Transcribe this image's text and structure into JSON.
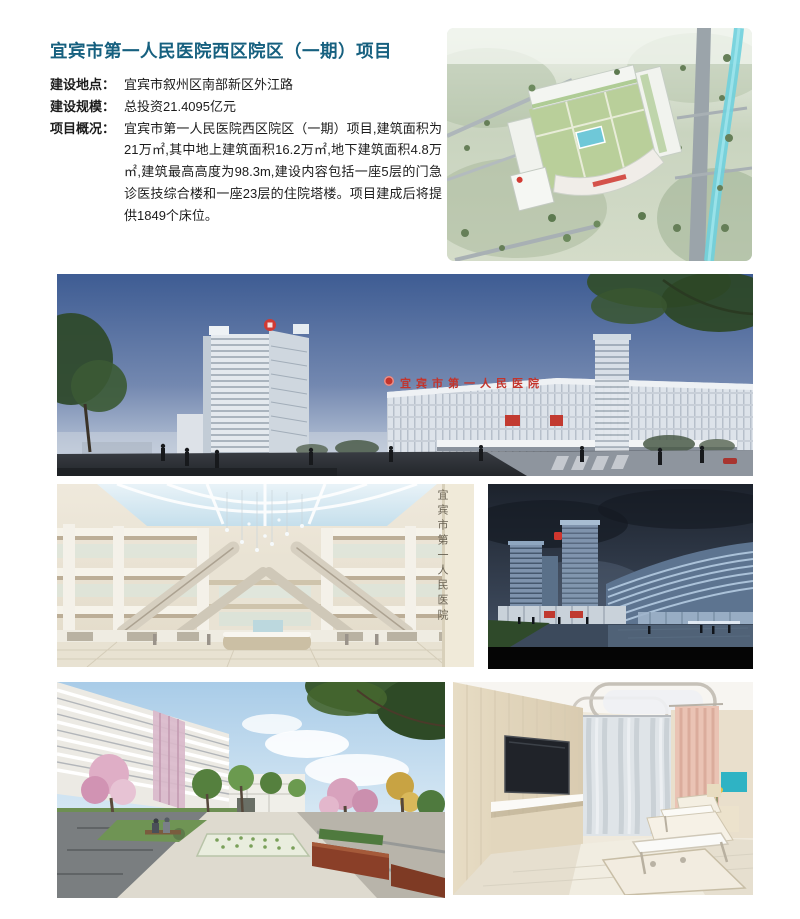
{
  "document": {
    "title": "宜宾市第一人民医院西区院区（一期）项目"
  },
  "info": {
    "rows": [
      {
        "label": "建设地点：",
        "value": "宜宾市叙州区南部新区外江路"
      },
      {
        "label": "建设规模：",
        "value": "总投资21.4095亿元"
      },
      {
        "label": "项目概况：",
        "value": "宜宾市第一人民医院西区院区（一期）项目,建筑面积为21万㎡,其中地上建筑面积16.2万㎡,地下建筑面积4.8万㎡,建筑最高高度为98.3m,建设内容包括一座5层的门急诊医技综合楼和一座23层的住院塔楼。项目建成后将提供1849个床位。"
      }
    ]
  },
  "figures": {
    "panorama": {
      "building_sign": "宜宾市第一人民医院"
    },
    "atrium": {
      "wall_sign": "宜宾市第一人民医院"
    }
  },
  "colors": {
    "title_accent": "#16607f",
    "hospital_sign_red": "#c3342c"
  }
}
